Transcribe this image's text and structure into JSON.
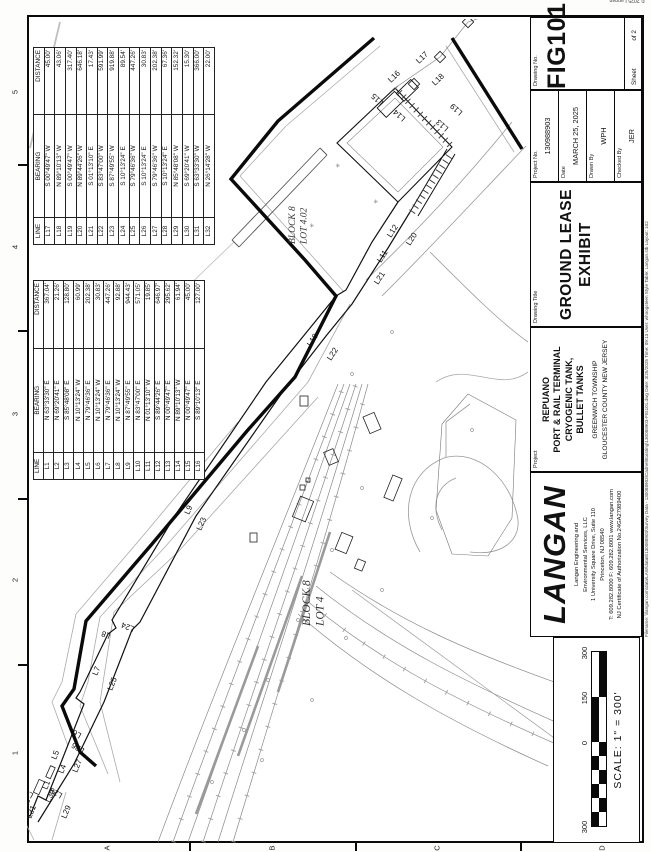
{
  "sheet": {
    "copyright": "© 2025 Langan",
    "plot_info": "Filename: \\\\langan.com\\data\\LAW\\data8\\130088903\\Survey Data - 130088903\\Cadnet\\Existing\\130088903-FIG101.dwg   Date: 3/25/2025   Time: 09:13   User: whoogsteen   Style Table: Langan.stb   Layout: 102",
    "zone_numbers": [
      "1",
      "2",
      "3",
      "4",
      "5"
    ],
    "zone_letters": [
      "A",
      "B",
      "C",
      "D"
    ]
  },
  "line_tables": {
    "headers": [
      "LINE",
      "BEARING",
      "DISTANCE"
    ],
    "table1": {
      "rows": [
        [
          "L1",
          "N 63°33'30\" E",
          "367.04'"
        ],
        [
          "L2",
          "N 69°20'41\" E",
          "21.26'"
        ],
        [
          "L3",
          "S 85°48'08\" E",
          "128.80'"
        ],
        [
          "L4",
          "N 10°13'24\" W",
          "60.99'"
        ],
        [
          "L5",
          "N 79°46'36\" E",
          "202.38'"
        ],
        [
          "L6",
          "N 10°13'24\" W",
          "30.83'"
        ],
        [
          "L7",
          "N 79°46'36\" E",
          "447.26'"
        ],
        [
          "L8",
          "N 10°13'24\" W",
          "92.88'"
        ],
        [
          "L9",
          "N 87°49'55\" E",
          "944.43'"
        ],
        [
          "L10",
          "N 83°47'00\" E",
          "571.05'"
        ],
        [
          "L11",
          "N 01°13'10\" W",
          "19.85'"
        ],
        [
          "L12",
          "S 89°44'26\" E",
          "646.97'"
        ],
        [
          "L13",
          "N 00°49'47\" E",
          "295.62'"
        ],
        [
          "L14",
          "N 89°10'13\" W",
          "61.94'"
        ],
        [
          "L15",
          "N 00°49'47\" E",
          "45.00'"
        ],
        [
          "L16",
          "S 89°10'13\" E",
          "127.00'"
        ]
      ]
    },
    "table2": {
      "rows": [
        [
          "L17",
          "S 00°49'47\" W",
          "45.00'"
        ],
        [
          "L18",
          "N 89°10'13\" W",
          "43.06'"
        ],
        [
          "L19",
          "S 00°49'47\" W",
          "317.40'"
        ],
        [
          "L20",
          "N 89°44'26\" W",
          "646.18'"
        ],
        [
          "L21",
          "S 01°13'10\" E",
          "17.43'"
        ],
        [
          "L22",
          "S 83°47'00\" W",
          "591.99'"
        ],
        [
          "L23",
          "S 87°49'55\" W",
          "919.88'"
        ],
        [
          "L24",
          "S 10°13'24\" E",
          "89.54'"
        ],
        [
          "L25",
          "S 79°46'36\" W",
          "447.26'"
        ],
        [
          "L26",
          "S 10°13'24\" E",
          "30.83'"
        ],
        [
          "L27",
          "S 79°46'36\" W",
          "202.38'"
        ],
        [
          "L28",
          "S 10°13'24\" E",
          "67.36'"
        ],
        [
          "L29",
          "N 85°48'08\" W",
          "152.32'"
        ],
        [
          "L30",
          "S 69°20'41\" W",
          "15.30'"
        ],
        [
          "L31",
          "S 63°33'30\" W",
          "366.00'"
        ],
        [
          "L32",
          "N 26°14'28\" W",
          "22.00'"
        ]
      ]
    }
  },
  "map": {
    "block_labels": [
      {
        "lines": [
          "BLOCK 8",
          "LOT 4"
        ],
        "x": 226,
        "y": 310,
        "size": 11.5
      },
      {
        "lines": [
          "BLOCK 8",
          "LOT 4.02"
        ],
        "x": 608,
        "y": 295,
        "size": 9.5
      }
    ],
    "line_labels": [
      {
        "t": "L1",
        "x": 62,
        "y": 47,
        "r": 22
      },
      {
        "t": "L2",
        "x": 44,
        "y": 27,
        "r": 22
      },
      {
        "t": "L3",
        "x": 58,
        "y": 34,
        "r": -60
      },
      {
        "t": "L4",
        "x": 78,
        "y": 63,
        "r": 22
      },
      {
        "t": "L5",
        "x": 92,
        "y": 56,
        "r": 22
      },
      {
        "t": "L6",
        "x": 118,
        "y": 82,
        "r": -60
      },
      {
        "t": "L7",
        "x": 176,
        "y": 97,
        "r": 22
      },
      {
        "t": "L8",
        "x": 218,
        "y": 111,
        "r": -68
      },
      {
        "t": "L9",
        "x": 337,
        "y": 189,
        "r": 24
      },
      {
        "t": "L10",
        "x": 505,
        "y": 311,
        "r": 33
      },
      {
        "t": "L11",
        "x": 589,
        "y": 381,
        "r": 33
      },
      {
        "t": "L12",
        "x": 614,
        "y": 391,
        "r": 33
      },
      {
        "t": "L13",
        "x": 724,
        "y": 449,
        "r": -48
      },
      {
        "t": "L14",
        "x": 734,
        "y": 406,
        "r": -48
      },
      {
        "t": "L15",
        "x": 750,
        "y": 384,
        "r": -48
      },
      {
        "t": "L16",
        "x": 769,
        "y": 391,
        "r": 46
      },
      {
        "t": "L17",
        "x": 788,
        "y": 419,
        "r": 46
      },
      {
        "t": "L18",
        "x": 766,
        "y": 435,
        "r": 46
      },
      {
        "t": "L19",
        "x": 740,
        "y": 463,
        "r": -48
      },
      {
        "t": "L20",
        "x": 606,
        "y": 410,
        "r": 33
      },
      {
        "t": "L21",
        "x": 567,
        "y": 378,
        "r": 33
      },
      {
        "t": "L22",
        "x": 491,
        "y": 331,
        "r": 33
      },
      {
        "t": "L23",
        "x": 321,
        "y": 201,
        "r": 24
      },
      {
        "t": "L24",
        "x": 225,
        "y": 135,
        "r": -68
      },
      {
        "t": "L25",
        "x": 161,
        "y": 112,
        "r": 22
      },
      {
        "t": "L26",
        "x": 103,
        "y": 85,
        "r": -60
      },
      {
        "t": "L27",
        "x": 79,
        "y": 77,
        "r": 22
      },
      {
        "t": "L28",
        "x": 58,
        "y": 63,
        "r": -60
      },
      {
        "t": "L29",
        "x": 33,
        "y": 66,
        "r": 22
      },
      {
        "t": "L30",
        "x": 49,
        "y": 50,
        "r": 22
      },
      {
        "t": "L31",
        "x": 33,
        "y": 31,
        "r": 22
      },
      {
        "t": "L32",
        "x": 50,
        "y": 30,
        "r": -60
      }
    ]
  },
  "title_block": {
    "langan": {
      "logo": "LANGAN",
      "address_lines": [
        "Langan Engineering and",
        "Environmental Services, LLC",
        "1 University Square Drive, Suite 110",
        "Princeton, NJ 08540",
        "T: 609.282.8000  F: 609.282.8001  www.langan.com",
        "NJ Certificate of Authorization No.24GA27989400"
      ]
    },
    "project_label": "Project",
    "project_lines": [
      "REPUANO",
      "PORT & RAIL TERMINAL",
      "CRYOGENIC TANK,",
      "BULLET TANKS"
    ],
    "location_lines": [
      "GREENWICH   TOWNSHIP",
      "GLOUCESTER   COUNTY      NEW JERSEY"
    ],
    "drawing_title_label": "Drawing Title",
    "drawing_title_lines": [
      "GROUND LEASE",
      "EXHIBIT"
    ],
    "info_rows": [
      {
        "label": "Project No.",
        "value": "130988903"
      },
      {
        "label": "Date",
        "value": "MARCH 25, 2025"
      },
      {
        "label": "Drawn By",
        "value": "WPH"
      },
      {
        "label": "Checked By",
        "value": "JER"
      }
    ],
    "drawing_no_label": "Drawing No.",
    "drawing_no": "FIG101",
    "sheet_label": "Sheet",
    "sheet_of": "of 2"
  },
  "scale_bar": {
    "labels": [
      {
        "t": "300",
        "x": 24
      },
      {
        "t": "0",
        "x": 108
      },
      {
        "t": "150",
        "x": 153
      },
      {
        "t": "300",
        "x": 198
      }
    ],
    "text": "SCALE: 1\" =  300'"
  }
}
